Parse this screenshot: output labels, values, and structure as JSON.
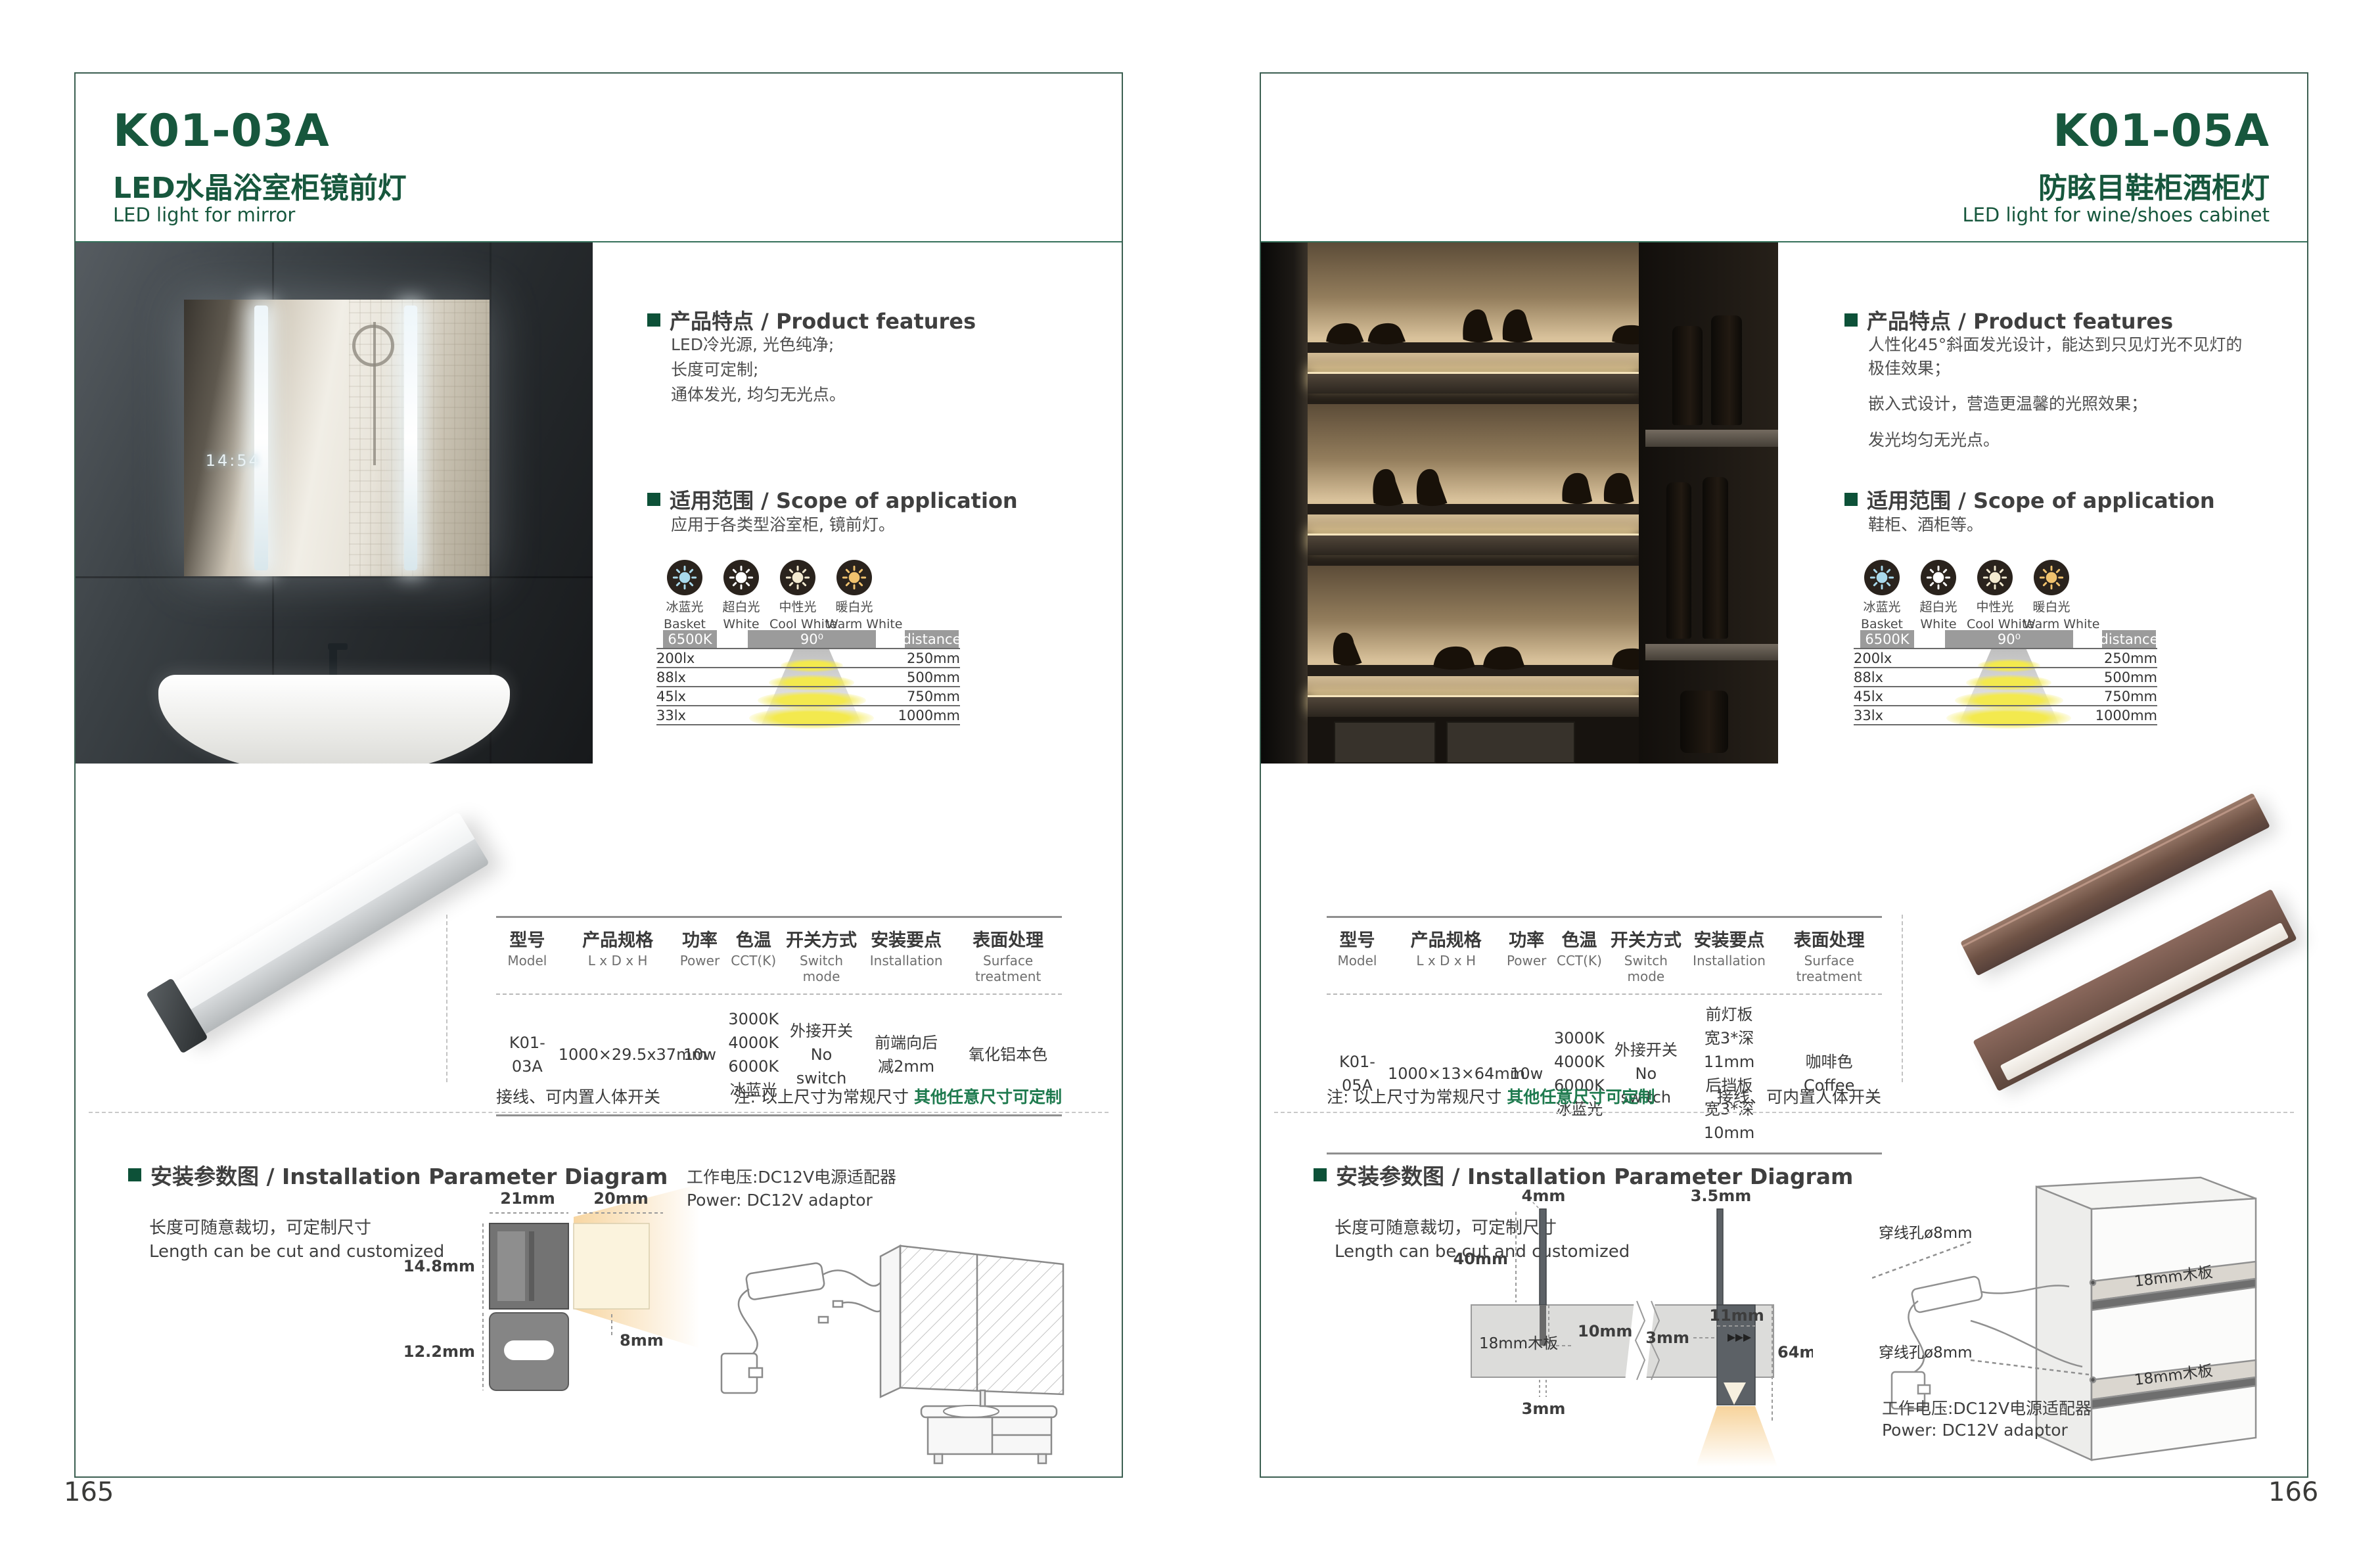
{
  "colors": {
    "accent_green": "#17573d",
    "note_green": "#1e7a4e",
    "badge_gray": "#9b9b9b",
    "coffee": "#7a5c4e",
    "ice_blue": "#a9d9ec",
    "warm_white": "#f0c26e"
  },
  "shared": {
    "cct_icons": [
      {
        "icon": "sun-icon",
        "label_cn": "冰蓝光",
        "label_en": "Basket",
        "color": "#a9d9ec"
      },
      {
        "icon": "sun-icon",
        "label_cn": "超白光",
        "label_en": "White",
        "color": "#ffffff"
      },
      {
        "icon": "sun-icon",
        "label_cn": "中性光",
        "label_en": "Cool White",
        "color": "#f3ead0"
      },
      {
        "icon": "sun-icon",
        "label_cn": "暖白光",
        "label_en": "Warm White",
        "color": "#f0c26e"
      }
    ],
    "photometry": {
      "cct_badge": "6500K",
      "angle_badge": "90⁰",
      "distance_badge": "distance",
      "rows": [
        {
          "lux": "200lx",
          "distance": "250mm"
        },
        {
          "lux": "88lx",
          "distance": "500mm"
        },
        {
          "lux": "45lx",
          "distance": "750mm"
        },
        {
          "lux": "33lx",
          "distance": "1000mm"
        }
      ]
    },
    "table_headers": [
      {
        "cn": "型号",
        "en": "Model"
      },
      {
        "cn": "产品规格",
        "en": "L x D x H"
      },
      {
        "cn": "功率",
        "en": "Power"
      },
      {
        "cn": "色温",
        "en": "CCT(K)"
      },
      {
        "cn": "开关方式",
        "en": "Switch mode"
      },
      {
        "cn": "安装要点",
        "en": "Installation"
      },
      {
        "cn": "表面处理",
        "en": "Surface treatment"
      }
    ],
    "install_heading": "安装参数图 / Installation Parameter Diagram",
    "cut_cn": "长度可随意裁切，可定制尺寸",
    "cut_en": "Length can be cut and customized",
    "power_cn": "工作电压:DC12V电源适配器",
    "power_en": "Power: DC12V adaptor",
    "note_wiring": "接线、可内置人体开关",
    "note_prefix": "注: 以上尺寸为常规尺寸 ",
    "note_green": "其他任意尺寸可定制"
  },
  "page_left": {
    "page_number": "165",
    "model": "K01-03A",
    "title_cn": "LED水晶浴室柜镜前灯",
    "title_en": "LED light for mirror",
    "features_heading": "产品特点 / Product features",
    "features": [
      "LED冷光源, 光色纯净;",
      "长度可定制;",
      "通体发光, 均匀无光点。"
    ],
    "scope_heading": "适用范围 / Scope of application",
    "scope": [
      "应用于各类型浴室柜, 镜前灯。"
    ],
    "photo_clock": "14:54",
    "table_row": {
      "model": "K01-03A",
      "size": "1000×29.5x37mm",
      "power": "10w",
      "cct": "3000K\n4000K\n6000K\n冰蓝光",
      "switch": "外接开关\nNo switch",
      "install": "前端向后\n减2mm",
      "surface": "氧化铝本色"
    },
    "diagram_dims": {
      "top_width": "21mm",
      "beam_width": "20mm",
      "upper_height": "14.8mm",
      "beam_height": "8mm",
      "lower_height": "12.2mm"
    }
  },
  "page_right": {
    "page_number": "166",
    "model": "K01-05A",
    "title_cn": "防眩目鞋柜酒柜灯",
    "title_en": "LED light for wine/shoes cabinet",
    "features_heading": "产品特点 / Product features",
    "features": [
      "人性化45°斜面发光设计，能达到只见灯光不见灯的极佳效果；",
      "嵌入式设计，营造更温馨的光照效果；",
      "发光均匀无光点。"
    ],
    "scope_heading": "适用范围 / Scope of application",
    "scope": [
      "鞋柜、酒柜等。"
    ],
    "table_row": {
      "model": "K01-05A",
      "size": "1000×13×64mm",
      "power": "10w",
      "cct": "3000K\n4000K\n6000K\n冰蓝光",
      "switch": "外接开关\nNo switch",
      "install": "前灯板\n宽3*深11mm\n后挡板\n宽3*深10mm",
      "surface": "咖啡色\nCoffee"
    },
    "diagram_dims": {
      "front_fin": "4mm",
      "rear_fin": "3.5mm",
      "fin_height": "40mm",
      "board": "18mm木板",
      "groove_depth": "10mm",
      "groove_width": "3mm",
      "rear_groove": "11mm",
      "rear_width": "3mm",
      "total_height": "64mm"
    },
    "cabinet": {
      "hole_label_1": "穿线孔ø8mm",
      "hole_label_2": "穿线孔ø8mm",
      "board_label_1": "18mm木板",
      "board_label_2": "18mm木板"
    }
  }
}
